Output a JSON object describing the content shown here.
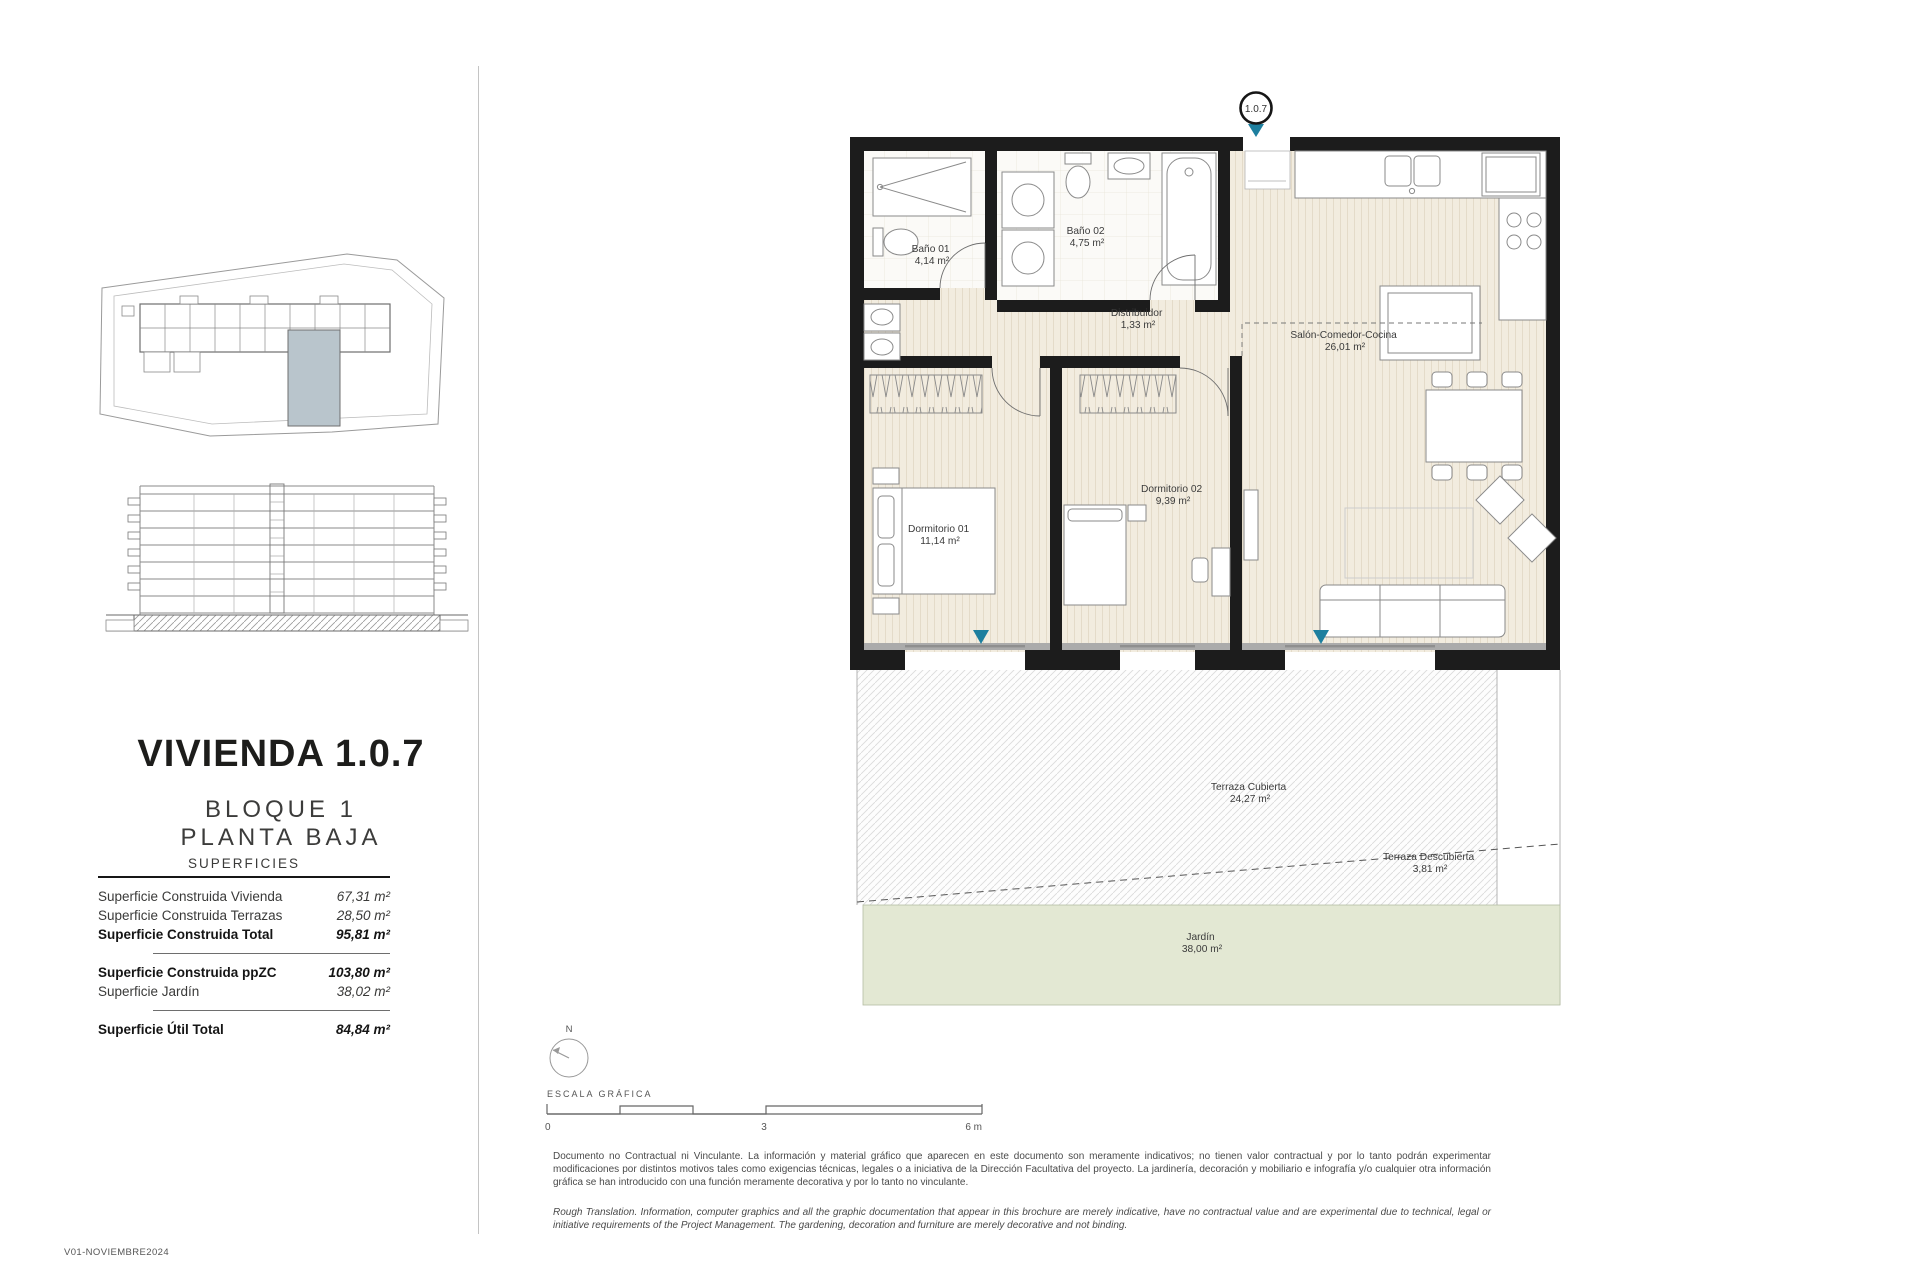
{
  "page": {
    "version_note": "V01-NOVIEMBRE2024"
  },
  "sidebar": {
    "title": "VIVIENDA 1.0.7",
    "subtitle_line1": "BLOQUE 1",
    "subtitle_line2": "PLANTA BAJA",
    "table": {
      "header": "SUPERFICIES",
      "rows": [
        {
          "label": "Superficie Construida Vivienda",
          "value": "67,31 m²"
        },
        {
          "label": "Superficie Construida Terrazas",
          "value": "28,50 m²"
        },
        {
          "label": "Superficie Construida Total",
          "value": "95,81 m²"
        },
        {
          "label": "Superficie Construida ppZC",
          "value": "103,80 m²"
        },
        {
          "label": "Superficie Jardín",
          "value": "38,02 m²"
        },
        {
          "label": "Superficie Útil Total",
          "value": "84,84 m²"
        }
      ]
    }
  },
  "plan": {
    "unit_badge": "1.0.7",
    "rooms": [
      {
        "name": "Baño 01",
        "area": "4,14 m²"
      },
      {
        "name": "Baño 02",
        "area": "4,75 m²"
      },
      {
        "name": "Distribuidor",
        "area": "1,33 m²"
      },
      {
        "name": "Salón-Comedor-Cocina",
        "area": "26,01 m²"
      },
      {
        "name": "Dormitorio 01",
        "area": "11,14 m²"
      },
      {
        "name": "Dormitorio 02",
        "area": "9,39 m²"
      },
      {
        "name": "Terraza Cubierta",
        "area": "24,27 m²"
      },
      {
        "name": "Terraza Descubierta",
        "area": "3,81 m²"
      },
      {
        "name": "Jardín",
        "area": "38,00 m²"
      }
    ],
    "colors": {
      "accent_teal": "#1d7f9f",
      "jardin_green": "#e3e8d3",
      "unit_highlight": "#b9c5cc"
    }
  },
  "scale": {
    "north_label": "N",
    "title": "ESCALA GRÁFICA",
    "tick0": "0",
    "tick3": "3",
    "tick6": "6 m"
  },
  "disclaimer": {
    "spanish": "Documento no Contractual ni Vinculante. La información y material gráfico que aparecen en este documento son meramente indicativos; no tienen valor contractual y por lo tanto podrán experimentar modificaciones por distintos motivos tales como exigencias técnicas, legales o a iniciativa de la Dirección Facultativa del proyecto. La jardinería, decoración y mobiliario e infografía y/o cualquier otra información gráfica se han introducido con una función meramente decorativa y por lo tanto no vinculante.",
    "english": "Rough Translation. Information, computer graphics and all the graphic documentation that appear in this brochure are merely indicative, have no contractual value and are experimental due to technical, legal or initiative requirements of the Project Management. The gardening, decoration and furniture are merely decorative and not binding."
  }
}
